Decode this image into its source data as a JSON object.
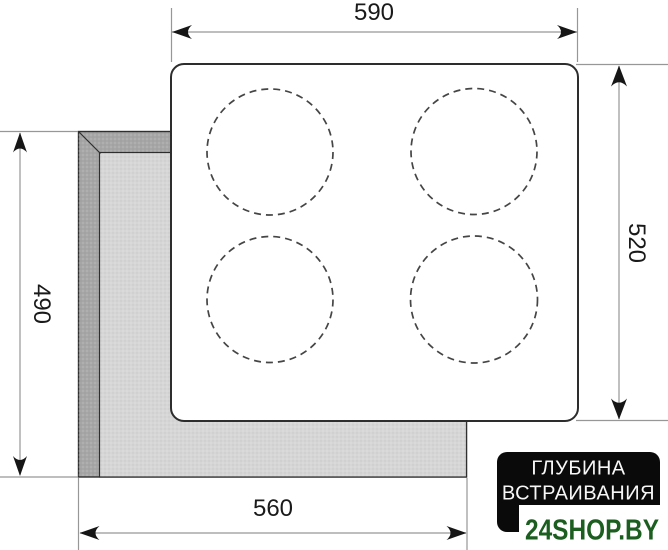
{
  "diagram": {
    "dimensions": {
      "top": {
        "value": "590",
        "edge": "cooktop-width"
      },
      "right": {
        "value": "520",
        "edge": "cooktop-depth"
      },
      "left": {
        "value": "490",
        "edge": "cutout-depth"
      },
      "bottom": {
        "value": "560",
        "edge": "cutout-width"
      }
    },
    "burners": {
      "count": 4
    },
    "badge": {
      "line1": "ГЛУБИНА",
      "line2": "ВСТРАИВАНИЯ"
    },
    "watermark": {
      "text": "24SHOP.BY"
    },
    "colors": {
      "ink": "#1a1a1a",
      "line_gray": "#979797",
      "panel_fill": "#ffffff",
      "panel_stroke": "#2d2d2d",
      "cutout_wall": "#a6a6a6",
      "cutout_floor": "#d6d6d6",
      "badge_bg": "#0a0a0a",
      "badge_text": "#f7f7f7",
      "watermark_green": "#1b5e20",
      "watermark_bg": "#ffffff"
    }
  }
}
